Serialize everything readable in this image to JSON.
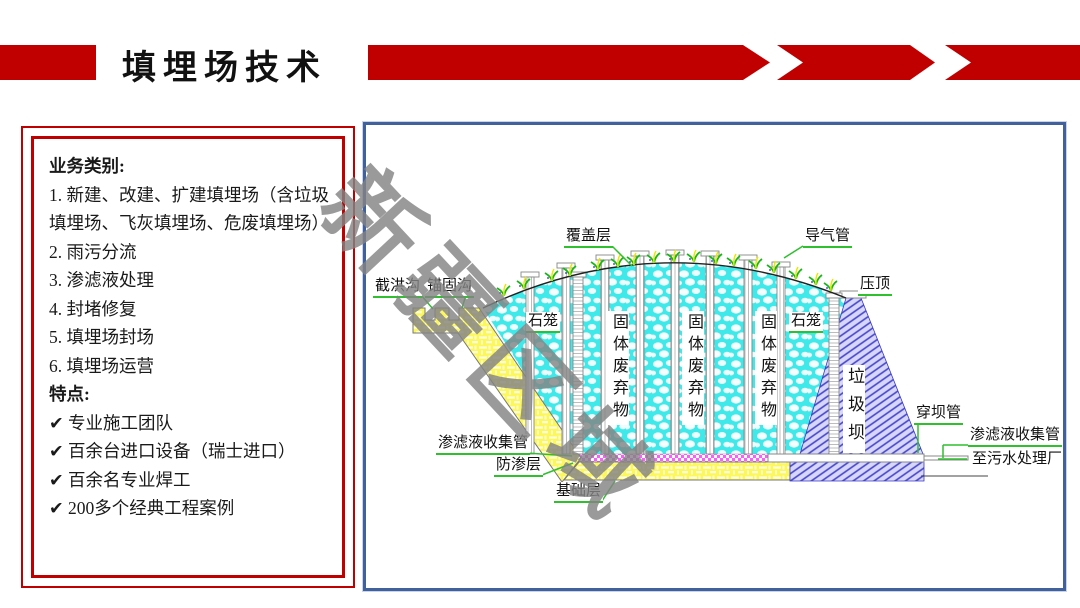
{
  "header": {
    "title": "填埋场技术"
  },
  "left_panel": {
    "business_heading": "业务类别:",
    "business_items": [
      "1. 新建、改建、扩建填埋场（含垃圾填埋场、飞灰填埋场、危废填埋场）",
      "2. 雨污分流",
      "3. 渗滤液处理",
      "4. 封堵修复",
      "5. 填埋场封场",
      "6. 填埋场运营"
    ],
    "features_heading": "特点:",
    "feature_items": [
      "✔ 专业施工团队",
      "✔ 百余台进口设备（瑞士进口）",
      "✔ 百余名专业焊工",
      "✔ 200多个经典工程案例"
    ]
  },
  "diagram": {
    "watermark": "新疆区域",
    "labels": {
      "cover_layer": "覆盖层",
      "gas_vent_pipe": "导气管",
      "capping": "压顶",
      "flood_interception_ditch": "截洪沟",
      "anchor_ditch": "锚固沟",
      "stone_cage": "石笼",
      "solid_waste": "固体废弃物",
      "garbage_dam": "垃圾坝",
      "leachate_collection_pipe": "渗滤液收集管",
      "impermeable_layer": "防渗层",
      "foundation_layer": "基础层",
      "dam_crossing_pipe": "穿坝管",
      "to_sewage_plant": "至污水处理厂"
    },
    "colors": {
      "accent_red": "#C00000",
      "panel_border_blue": "#41619C",
      "leader_green": "#2FBF2F",
      "waste_cyan": "#3FE9E9",
      "liner_yellow": "#FDF85A",
      "seepage_magenta": "#FF5CFF",
      "dam_lavender": "#D6D6FF",
      "watermark_gray": "#848484"
    }
  }
}
